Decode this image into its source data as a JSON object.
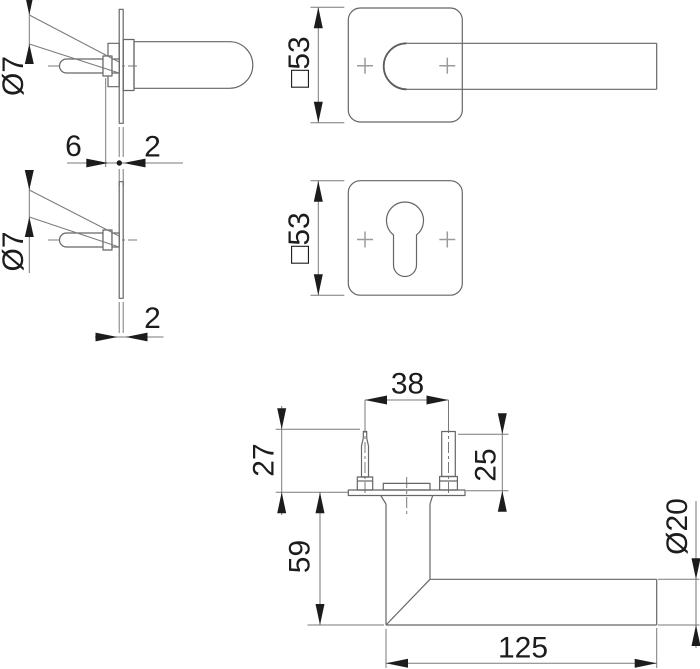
{
  "drawing": {
    "type": "technical-drawing-door-handle-set",
    "colors": {
      "background": "#ffffff",
      "outline": "#666666",
      "dimension_line": "#7a7a7a",
      "dimension_text": "#1c1c1c",
      "cross_mark": "#9b9b9b"
    },
    "dims": {
      "rose_side": {
        "screw_diameter": "Ø7",
        "offset": "6",
        "plate_thickness": "2"
      },
      "plate_side": {
        "screw_diameter": "Ø7",
        "plate_thickness": "2"
      },
      "lever_front": {
        "rose_size": "□53"
      },
      "escutcheon_front": {
        "rose_size": "□53"
      },
      "lever_side": {
        "screw_spacing": "38",
        "pin_length": "27",
        "stud_length": "25",
        "neck_height": "59",
        "grip_diameter": "Ø20",
        "lever_length": "125"
      }
    }
  }
}
